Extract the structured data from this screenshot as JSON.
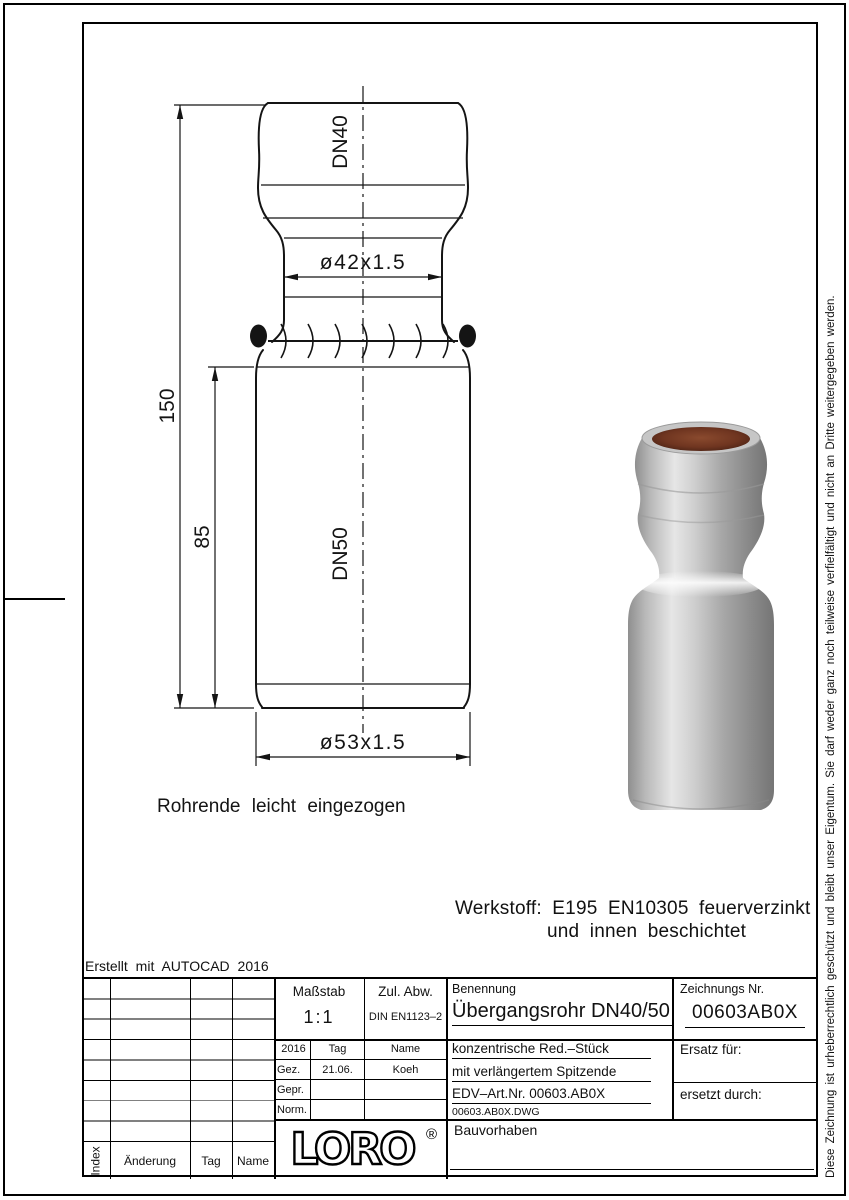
{
  "drawing": {
    "dn_top": "DN40",
    "dn_bottom": "DN50",
    "dim_width_top": "ø42x1.5",
    "dim_width_bottom": "ø53x1.5",
    "dim_height_total": "150",
    "dim_height_body": "85",
    "note": "Rohrende leicht eingezogen",
    "material_line1": "Werkstoff:  E195 EN10305 feuerverzinkt",
    "material_line2": "und innen beschichtet",
    "created_with": "Erstellt mit AUTOCAD 2016"
  },
  "titleblock": {
    "massstab_label": "Maßstab",
    "massstab_value": "1:1",
    "zul_abw_label": "Zul. Abw.",
    "zul_abw_value": "DIN EN1123–2",
    "benennung_label": "Benennung",
    "benennung_value": "Übergangsrohr DN40/50",
    "zeichnungs_nr_label": "Zeichnungs Nr.",
    "zeichnungs_nr_value": "00603AB0X",
    "year": "2016",
    "tag_label": "Tag",
    "name_label": "Name",
    "gez_label": "Gez.",
    "gez_tag": "21.06.",
    "gez_name": "Koeh",
    "gepr_label": "Gepr.",
    "norm_label": "Norm.",
    "desc_line1": "konzentrische Red.–Stück",
    "desc_line2": "mit verlängertem Spitzende",
    "desc_line3": "EDV–Art.Nr.  00603.AB0X",
    "file_name": "00603.AB0X.DWG",
    "ersatz_fuer": "Ersatz für:",
    "ersetzt_durch": "ersetzt durch:",
    "bauvorhaben_label": "Bauvorhaben",
    "logo_text": "LORO",
    "logo_reg": "®"
  },
  "revision_table": {
    "index_label": "Index",
    "aenderung_label": "Änderung",
    "tag_label": "Tag",
    "name_label": "Name"
  },
  "copyright_vertical": "Diese Zeichnung ist urheberrechtlich geschützt und bleibt unser Eigentum. Sie darf weder ganz noch teilweise verfielfältigt und nicht an Dritte weitergegeben werden.",
  "colors": {
    "line": "#141414",
    "metal_light": "#e6e6e6",
    "metal_mid": "#a8a8a8",
    "metal_dark": "#757575",
    "bore_brown": "#6f3520"
  }
}
